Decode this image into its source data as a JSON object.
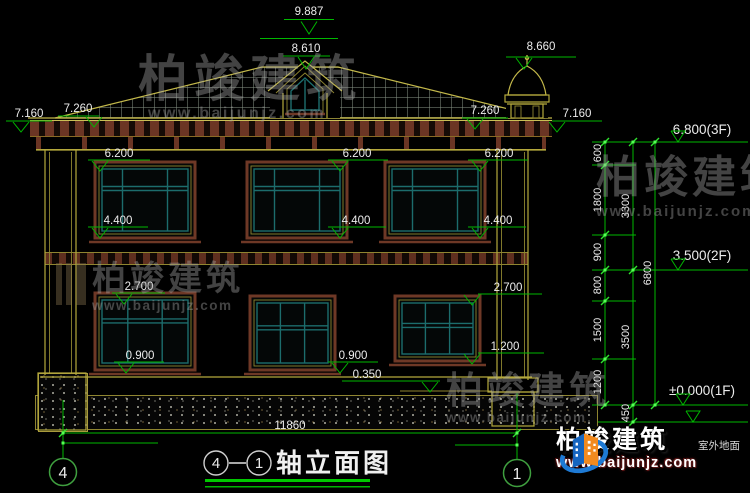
{
  "elevations": {
    "ridge": "9.887",
    "dormer": "8.610",
    "chimney": "8.660",
    "eave_a": "7.160",
    "eave_b": "7.260",
    "f2_head": "6.200",
    "f2_sill": "4.400",
    "f1_head": "2.700",
    "f1_sill": "0.900",
    "f1_sill_small": "1.200",
    "porch": "0.350"
  },
  "levels": {
    "f3": "6.800(3F)",
    "f2": "3.500(2F)",
    "f1": "±0.000(1F)",
    "ground_note": "室外地面"
  },
  "dims": {
    "v1": [
      "600",
      "1800",
      "900",
      "800",
      "1500",
      "1200"
    ],
    "v2": [
      "3300",
      "3500",
      "450"
    ],
    "v3": [
      "6800"
    ],
    "width": "11860"
  },
  "axes": {
    "left": "4",
    "right": "1"
  },
  "title": {
    "a": "4",
    "b": "1",
    "name": "轴立面图"
  },
  "watermark": {
    "brand": "柏竣建筑",
    "url": "www.baijunjz.com"
  },
  "logo": {
    "brand": "柏竣建筑",
    "url": "www.baijunjz.com"
  },
  "colors": {
    "line_green": "#00b800",
    "line_yellow": "#b5a93c",
    "frame_brown": "#6e3826",
    "sash_teal": "#1c6c6c",
    "logo_blue": "#1565c0",
    "logo_orange": "#f28a1e"
  }
}
